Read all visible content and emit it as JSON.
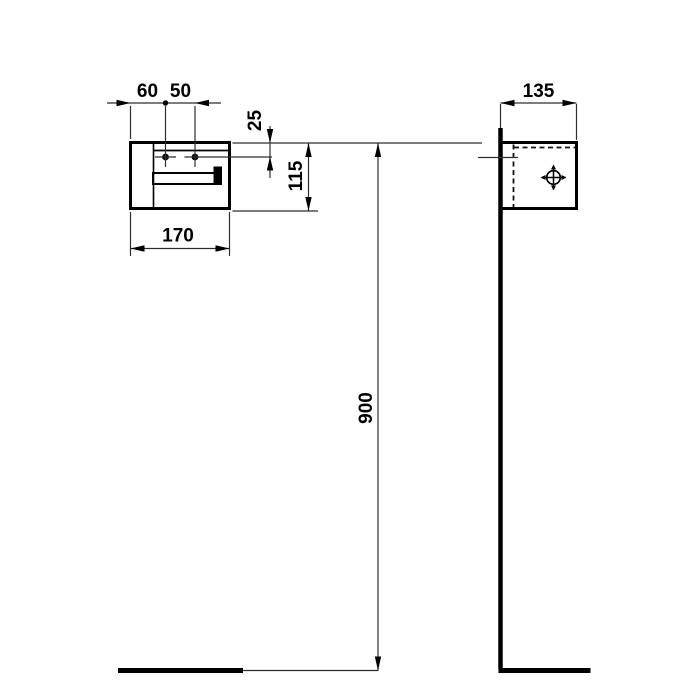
{
  "drawing": {
    "front_view": {
      "width_label": "170",
      "height_label": "115",
      "hole_spacing_left_label": "60",
      "hole_spacing_right_label": "50",
      "hole_top_offset_label": "25"
    },
    "side_view": {
      "depth_label": "135",
      "mounting_height_label": "900"
    },
    "colors": {
      "outline": "#000000",
      "dimension_line": "#2e2e2e",
      "background": "#ffffff"
    }
  }
}
